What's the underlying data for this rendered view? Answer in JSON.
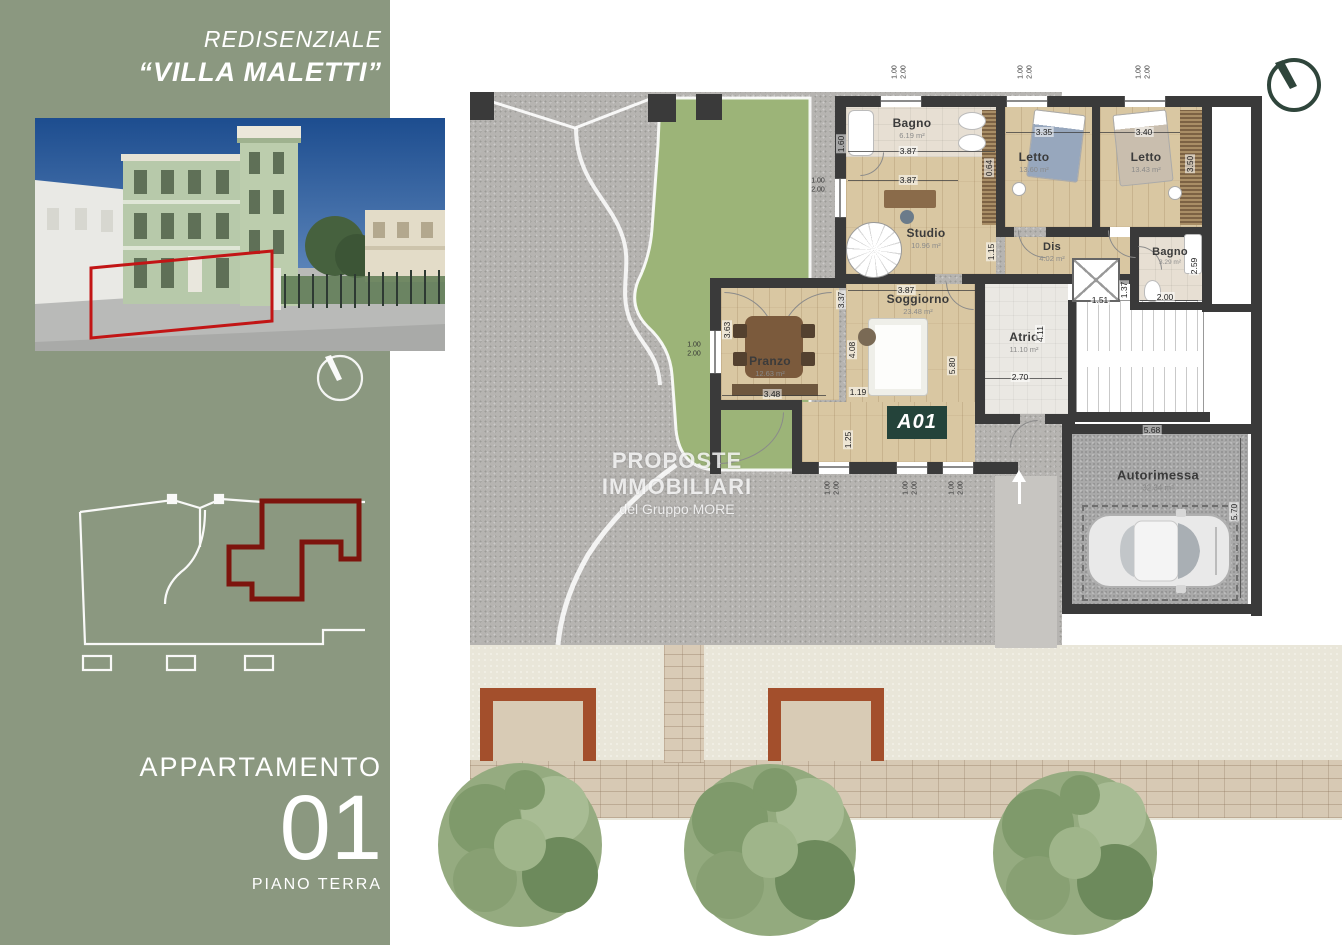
{
  "header": {
    "line1": "REDISENZIALE",
    "line2": "“VILLA MALETTI”"
  },
  "apartment": {
    "label": "APPARTAMENTO",
    "number": "01",
    "floor": "PIANO TERRA",
    "badge": "A01"
  },
  "watermark": {
    "line1": "PROPOSTE IMMOBILIARI",
    "line2": "del Gruppo MORE"
  },
  "rooms": {
    "bagno1": {
      "name": "Bagno",
      "area": "6.19 m²"
    },
    "studio": {
      "name": "Studio",
      "area": "10.96 m²"
    },
    "letto1": {
      "name": "Letto",
      "area": "13.60 m²"
    },
    "letto2": {
      "name": "Letto",
      "area": "13.43 m²"
    },
    "dis": {
      "name": "Dis",
      "area": "4.02 m²"
    },
    "bagno2": {
      "name": "Bagno",
      "area": "3.29 m²"
    },
    "soggiorno": {
      "name": "Soggiorno",
      "area": "23.48 m²"
    },
    "pranzo": {
      "name": "Pranzo",
      "area": "12.63 m²"
    },
    "atrio": {
      "name": "Atrio",
      "area": "11.10 m²"
    },
    "autorimessa": {
      "name": "Autorimessa",
      "area": "32.34 m²"
    }
  },
  "dims": {
    "bagno1_h": "1.60",
    "bagno1_w": "3.87",
    "studio_w": "3.87",
    "studio_h": "3.37",
    "soggiorno_w": "3.87",
    "letto1_w": "3.35",
    "letto2_w": "3.40",
    "ward1": "0.64",
    "ward2": "3.50",
    "dis_h": "1.15",
    "bagno2_h": "2.59",
    "bagno2_w": "2.00",
    "elev_w": "1.51",
    "elev_h": "1.37",
    "atrio_h": "4.11",
    "atrio_w": "2.70",
    "sog_h1": "4.08",
    "sog_h2": "5.80",
    "sog_b1": "1.19",
    "sog_b2": "1.25",
    "pranzo_h": "3.63",
    "pranzo_w": "3.48",
    "garage_w": "5.68",
    "garage_h": "5.70",
    "win_w": "1.00",
    "win_h": "2.00"
  },
  "colors": {
    "sidebar_green": "#8b9880",
    "badge_green": "#24433a",
    "wall_dark": "#3a3a3a",
    "highlight_red": "#c21515",
    "keyplan_red": "#7d140d",
    "terracotta": "#a34f2c",
    "garden_green": "#9cb478"
  }
}
